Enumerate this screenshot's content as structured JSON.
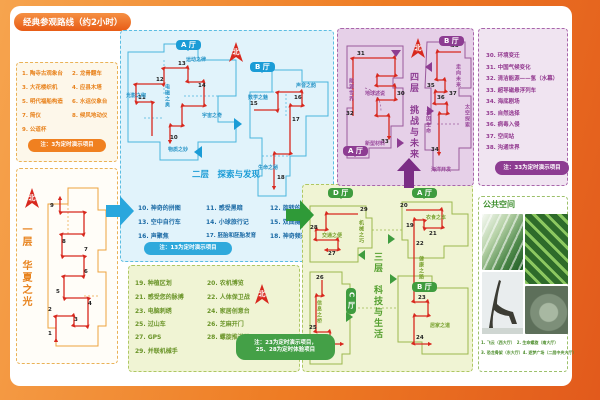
{
  "title": "经典参观路线（约2小时）",
  "compass": "北",
  "floor1": {
    "title_vertical": "一层　华夏之光",
    "items": [
      "1. 陶寺古观象台",
      "2. 龙骨翻车",
      "3. 大花楼织机",
      "4. 应县木塔",
      "5. 明代福船构造",
      "6. 水运仪象台",
      "7. 简仪",
      "8. 候风地动仪",
      "9. 公道杯"
    ],
    "note": "注：3为定时演示项目",
    "stops": [
      "1",
      "2",
      "3",
      "4",
      "5",
      "6",
      "7",
      "8",
      "9"
    ]
  },
  "floor2": {
    "title": "二层　探索与发现",
    "halls": {
      "a": "A 厅",
      "b": "B 厅"
    },
    "areas": {
      "guangying": "光影之绚",
      "dianci": "电磁之奥",
      "yundong": "运动之律",
      "yuzhou": "宇宙之奇",
      "wuzhi": "物质之妙",
      "shuxue": "数学之魅",
      "shengyin": "声音之韵",
      "shengming": "生命之秘"
    },
    "items": [
      "10. 神奇的拼图",
      "11. 感受黑暗",
      "12. 旋转的金蛋",
      "13. 空中自行车",
      "14. 小球旅行记",
      "15. 双曲隧道",
      "16. 声聚焦",
      "17. 胚胎和胚胎发育",
      "18. 神奇频道"
    ],
    "note": "注：13为定时演示项目",
    "stops": [
      "10",
      "11",
      "12",
      "13",
      "14",
      "15",
      "16",
      "17",
      "18"
    ]
  },
  "floor3": {
    "title_vertical": "三层　科技与生活",
    "halls": {
      "a": "A 厅",
      "b": "B 厅",
      "c": "C 厅",
      "d": "D 厅"
    },
    "areas": {
      "jiaotong": "交通之便",
      "jixie": "机械之巧",
      "yishi": "衣食之本",
      "jiankang": "健康之路",
      "xinxi": "信息之桥",
      "jujia": "居家之道"
    },
    "items": [
      "19. 种植区划",
      "20. 农机博览",
      "21. 感受您的脉搏",
      "22. 人体保卫战",
      "23. 电脑刺绣",
      "24. 家居创意台",
      "25. 过山车",
      "26. 芝麻开门",
      "27. GPS",
      "28. 螺旋推进器",
      "29. 并联机械手"
    ],
    "note_line1": "注：23为定时演示项目，",
    "note_line2": "25、28为定时体验项目",
    "stops": [
      "19",
      "20",
      "21",
      "22",
      "23",
      "24",
      "25",
      "26",
      "27",
      "28",
      "29"
    ]
  },
  "floor4": {
    "title_vertical": "四层　挑战与未来",
    "halls": {
      "a": "A 厅",
      "b": "B 厅"
    },
    "areas": {
      "nengyuan": "能源世界",
      "diqiu": "地球述说",
      "xinxing": "新型材料",
      "zouxiang": "走向未来",
      "jiyin": "基因生命",
      "taikong": "太空探索",
      "haiyang": "海洋开发"
    },
    "items": [
      "30. 环境变迁",
      "31. 中国气候变化",
      "32. 清洁能源——氢（水幕）",
      "33. 超导磁悬浮列车",
      "34. 海底剧场",
      "35. 自然选择",
      "36. 病毒入侵",
      "37. 空间站",
      "38. 沟通世界"
    ],
    "note": "注：33为定时演示项目",
    "stops": [
      "30",
      "31",
      "32",
      "33",
      "34",
      "35",
      "36",
      "37",
      "38"
    ]
  },
  "public_space": {
    "title": "公共空间",
    "captions_line1": "1. 飞云（西大厅）　2. 生命螺旋（南大厅）",
    "captions_line2": "3. 恐龙骨架（东大厅）4. 逐梦广场（二层中央大厅）"
  }
}
